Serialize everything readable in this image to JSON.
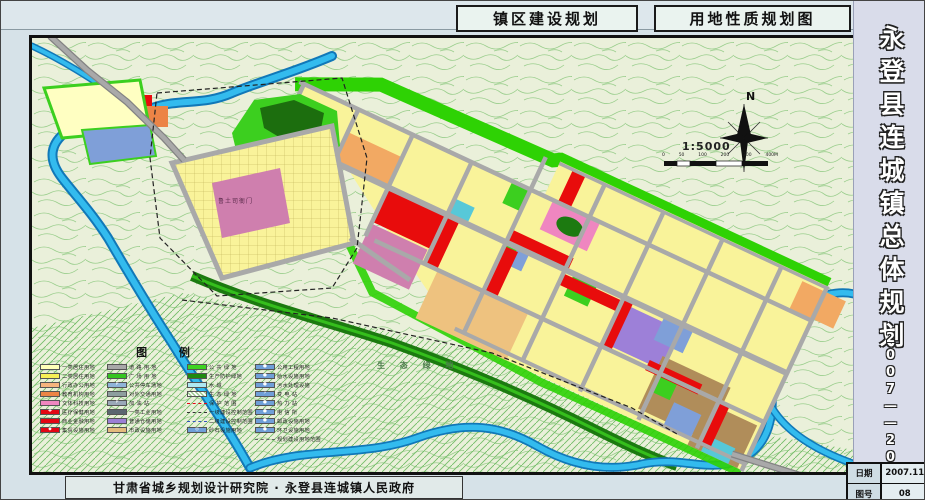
{
  "titles": {
    "left": "镇区建设规划",
    "right": "用地性质规划图"
  },
  "sidebar": {
    "title": "永登县连城镇总体规划",
    "years": "2007——2020"
  },
  "footer": {
    "credit": "甘肃省城乡规划设计研究院 · 永登县连城镇人民政府"
  },
  "info_table": {
    "rows": [
      {
        "label": "日期",
        "value": "2007.11"
      },
      {
        "label": "图号",
        "value": "08"
      }
    ]
  },
  "map": {
    "north_label": "N",
    "scale_text": "1:5000",
    "scale_ticks": [
      "0",
      "50",
      "100",
      "200",
      "300",
      "400M"
    ],
    "labels": {
      "yamen": "鲁土司衙门",
      "eco": "生 态 绿 地"
    }
  },
  "legend": {
    "title": "图 例",
    "columns": [
      {
        "items": [
          {
            "label": "一类居住用地",
            "type": "solid",
            "color": "#ffffb8"
          },
          {
            "label": "二类居住用地",
            "type": "solid",
            "color": "#f7ef56"
          },
          {
            "label": "行政办公用地",
            "type": "solid",
            "color": "#f6b47e"
          },
          {
            "label": "教育机构用地",
            "type": "solid",
            "color": "#ec8446"
          },
          {
            "label": "文体科技用地",
            "type": "solid",
            "color": "#ef86c0"
          },
          {
            "label": "医疗保健用地",
            "type": "solid",
            "color": "#e30613",
            "icon": "✚"
          },
          {
            "label": "商业金融用地",
            "type": "solid",
            "color": "#e30613"
          },
          {
            "label": "集贸设施用地",
            "type": "solid",
            "color": "#e30613",
            "icon": "◆"
          }
        ]
      },
      {
        "items": [
          {
            "label": "道 路 用 地",
            "type": "solid",
            "color": "#a8a8a8"
          },
          {
            "label": "广 场 用 地",
            "type": "dots",
            "color": "#35c420"
          },
          {
            "label": "公共停车场地",
            "type": "solid",
            "color": "#8fb4d9",
            "icon": "P"
          },
          {
            "label": "对外交通用地",
            "type": "solid",
            "color": "#8d9e9e"
          },
          {
            "label": "加 油 站",
            "type": "solid",
            "color": "#9aa8b8",
            "icon": "P"
          },
          {
            "label": "一类工业用地",
            "type": "solid",
            "color": "#5a6670"
          },
          {
            "label": "普通仓储用地",
            "type": "solid",
            "color": "#9b7fd4"
          },
          {
            "label": "市政设施用地",
            "type": "solid",
            "color": "#e3bb7c"
          }
        ]
      },
      {
        "items": [
          {
            "label": "公 共 绿 地",
            "type": "dots",
            "color": "#3ed321"
          },
          {
            "label": "生产防护绿地",
            "type": "solid",
            "color": "#1f8a10"
          },
          {
            "label": "水  域",
            "type": "solid",
            "color": "#aee8f2"
          },
          {
            "label": "生 态 绿 地",
            "type": "hatch",
            "color": "#d9ecd0"
          },
          {
            "label": "保 护 范 围",
            "type": "dashdot",
            "color": "#e30613"
          },
          {
            "label": "一级建设控制范围",
            "type": "line",
            "color": "#333333"
          },
          {
            "label": "二级建设控制范围",
            "type": "line",
            "color": "#3355bb"
          },
          {
            "label": "砂石设施用地",
            "type": "solid",
            "color": "#6f9fd8",
            "icon": "◎"
          }
        ]
      },
      {
        "items": [
          {
            "label": "公用工程用地",
            "type": "solid",
            "color": "#6f9fd8",
            "icon": "●"
          },
          {
            "label": "给水设施用地",
            "type": "solid",
            "color": "#6f9fd8",
            "icon": "●"
          },
          {
            "label": "污水处理设施",
            "type": "solid",
            "color": "#6f9fd8",
            "icon": "●"
          },
          {
            "label": "变 电 站",
            "type": "solid",
            "color": "#6f9fd8",
            "icon": "⚡"
          },
          {
            "label": "热 力 站",
            "type": "solid",
            "color": "#6f9fd8",
            "icon": "●"
          },
          {
            "label": "电 信 所",
            "type": "solid",
            "color": "#6f9fd8",
            "icon": "●"
          },
          {
            "label": "邮政设施用地",
            "type": "solid",
            "color": "#6f9fd8",
            "icon": "●"
          },
          {
            "label": "环卫设施用地",
            "type": "solid",
            "color": "#6f9fd8",
            "icon": "●"
          },
          {
            "label": "规划建设用地范围",
            "type": "line",
            "color": "#666666"
          }
        ]
      }
    ]
  },
  "palette": {
    "base": "#eaf0da",
    "contour": "#8cc87f",
    "hatch": "#74bd68",
    "water": "#33bbee",
    "waterEdge": "#1178b8",
    "waterLight": "#a5ecf8",
    "road": "#a9a9a9",
    "roadEdge": "#838383",
    "yellow": "#f9f39a",
    "paleYellow": "#ffffc2",
    "orange": "#f2a963",
    "deepOrange": "#ec8446",
    "red": "#e80c0c",
    "pink": "#ef86c0",
    "mauve": "#cf7fae",
    "purple": "#9d80d8",
    "brown": "#b08d5a",
    "tan": "#eec27f",
    "cyan": "#57c8d8",
    "blue": "#7f9fd8",
    "green": "#3ccf1f",
    "darkGreen": "#1c7a10",
    "buffer": "#2ed204"
  }
}
